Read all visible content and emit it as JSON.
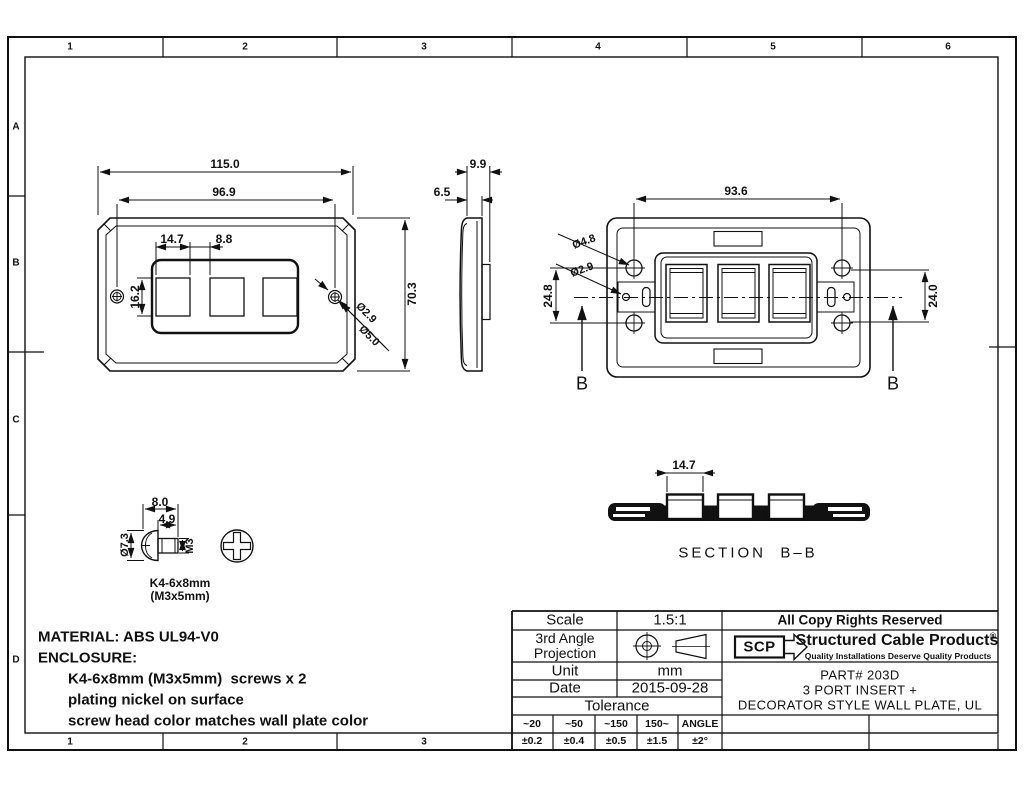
{
  "border": {
    "cols": [
      "1",
      "2",
      "3",
      "4",
      "5",
      "6"
    ],
    "rows": [
      "A",
      "B",
      "C",
      "D"
    ]
  },
  "front_view": {
    "dim_width_overall": "115.0",
    "dim_screw_span": "96.9",
    "dim_port_width": "14.7",
    "dim_port_gap": "8.8",
    "dim_port_height": "16.2",
    "dim_height_overall": "70.3",
    "dim_screw_hole_small": "Ø2.9",
    "dim_screw_hole_large": "Ø5.0"
  },
  "side_view": {
    "dim_depth_overall": "9.9",
    "dim_depth_body": "6.5"
  },
  "back_view": {
    "dim_screw_span": "93.6",
    "dim_boss_dia": "Ø4.8",
    "dim_hole_dia": "Ø2.9",
    "dim_left_span": "24.8",
    "dim_right_span": "24.0",
    "section_letter": "B"
  },
  "screw_detail": {
    "dim_head_width": "8.0",
    "dim_shaft_length": "4.9",
    "dim_head_dia": "Ø7.3",
    "dim_thread": "M3",
    "label_line1": "K4-6x8mm",
    "label_line2": "(M3x5mm)"
  },
  "section_view": {
    "dim_port_width": "14.7",
    "title": "SECTION  B–B"
  },
  "notes": {
    "lines": [
      "MATERIAL: ABS UL94-V0",
      "ENCLOSURE:",
      "K4-6x8mm (M3x5mm)  screws x 2",
      "plating nickel on surface",
      "screw head color matches wall plate color"
    ]
  },
  "title_block": {
    "scale_label": "Scale",
    "scale_value": "1.5:1",
    "projection_label": "3rd Angle Projection",
    "unit_label": "Unit",
    "unit_value": "mm",
    "date_label": "Date",
    "date_value": "2015-09-28",
    "tolerance_label": "Tolerance",
    "tolerance_headers": [
      "~20",
      "~50",
      "~150",
      "150~",
      "ANGLE"
    ],
    "tolerance_values": [
      "±0.2",
      "±0.4",
      "±0.5",
      "±1.5",
      "±2°"
    ],
    "rights": "All Copy Rights Reserved",
    "logo_text": "SCP",
    "company": "Structured Cable Products",
    "company_reg": "®",
    "tagline": "Quality Installations Deserve Quality Products",
    "part_number": "PART# 203D",
    "part_desc_1": "3 PORT INSERT +",
    "part_desc_2": "DECORATOR STYLE WALL PLATE, UL"
  },
  "colors": {
    "ink": "#111111",
    "paper": "#ffffff"
  }
}
